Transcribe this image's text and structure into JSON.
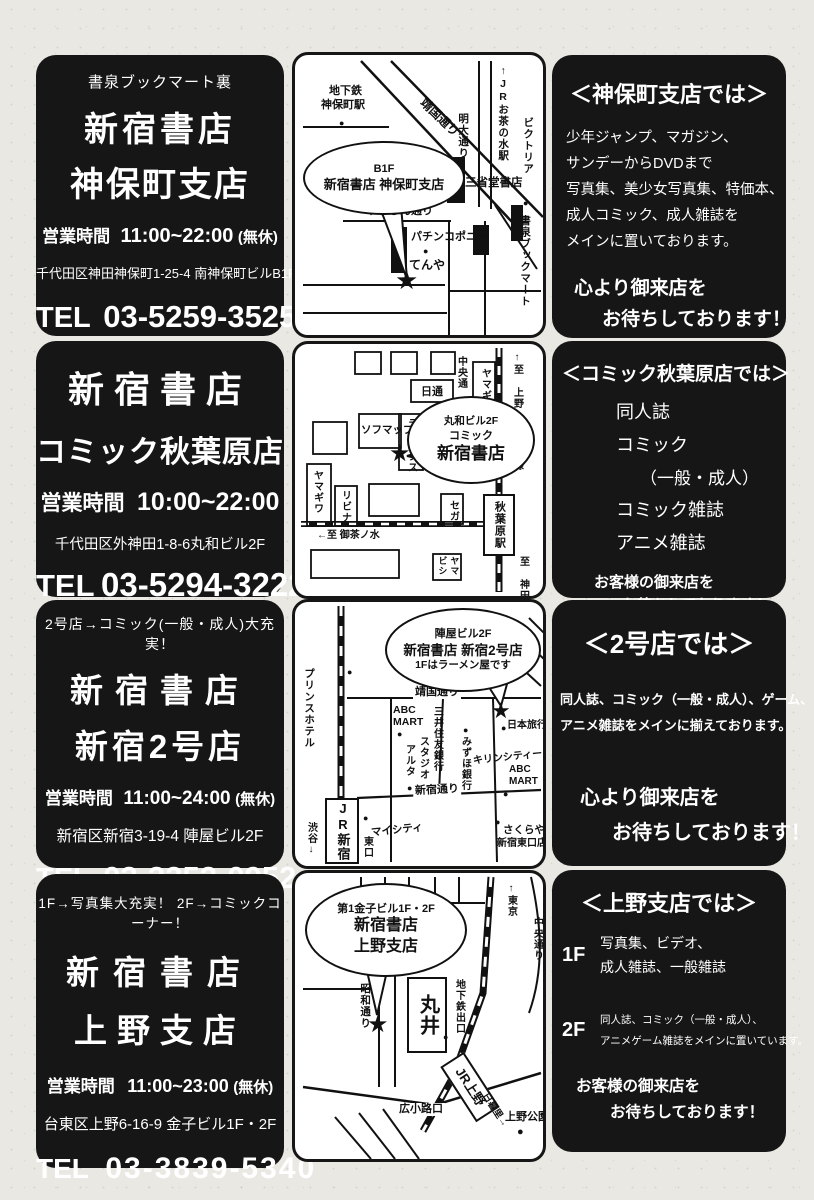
{
  "icons": {
    "star": "★",
    "dot": "●"
  },
  "stores": [
    {
      "info": {
        "tagline": "書泉ブックマート裏",
        "name1": "新宿書店",
        "name2": "神保町支店",
        "hours_label": "営業時間",
        "hours": "11:00~22:00",
        "hours_note": "(無休)",
        "address": "千代田区神田神保町1-25-4 南神保町ビルB1F",
        "tel_label": "TEL",
        "tel": "03-5259-3525"
      },
      "map": {
        "subway1": "地下鉄",
        "subway2": "神保町駅",
        "yasukuni": "靖国通り",
        "jr_ochanomizu": "↑JRお茶の水駅",
        "meidai": "明大通り",
        "victoria": "ビクトリア",
        "sanseido": "三省堂書店",
        "suzuran": "すずらん通り",
        "pachinko": "パチンコポニー",
        "tenya": "てんや",
        "shosen": "書泉ブックマート",
        "balloon1": "B1F",
        "balloon2": "新宿書店 神保町支店"
      },
      "desc": {
        "heading": "＜神保町支店では＞",
        "line1": "少年ジャンプ、マガジン、",
        "line2": "サンデーからDVDまで",
        "line3": "写真集、美少女写真集、特価本、",
        "line4": "成人コミック、成人雑誌を",
        "line5": "メインに置いております。",
        "closing1": "心より御来店を",
        "closing2": "お待ちしております！"
      }
    },
    {
      "info": {
        "name1": "新宿書店",
        "name2": "コミック秋葉原店",
        "hours_label": "営業時間",
        "hours": "10:00~22:00",
        "address": "千代田区外神田1-8-6丸和ビル2F",
        "tel_label": "TEL",
        "tel": "03-5294-3222"
      },
      "map": {
        "chuo": "中央通",
        "yamagiwa_top": "ヤマギワ",
        "to_ueno": "↑至 上野",
        "yamanote": "山手線",
        "nittsu": "日通",
        "laox": "ラオックス",
        "sofmap": "ソフマップ",
        "balloon1": "丸和ビル2F",
        "balloon2": "コミック",
        "balloon3": "新宿書店",
        "yamagiwa_left": "ヤマギワ",
        "livina": "リビナ",
        "sega": "セガ",
        "station": "秋葉原駅",
        "to_ochanomizu": "←至 御茶ノ水",
        "yamabishi1": "ヤマ",
        "yamabishi2": "ビシ",
        "to_kanda": "至 神田↓"
      },
      "desc": {
        "heading": "＜コミック秋葉原店では＞",
        "item1": "同人誌",
        "item2": "コミック",
        "item3": "（一般・成人）",
        "item4": "コミック雑誌",
        "item5": "アニメ雑誌",
        "closing1": "お客様の御来店を",
        "closing2": "お待ちしております！"
      }
    },
    {
      "info": {
        "tagline": "2号店→コミック(一般・成人)大充実！",
        "name1": "新宿書店",
        "name2": "新宿2号店",
        "hours_label": "営業時間",
        "hours": "11:00~24:00",
        "hours_note": "(無休)",
        "address": "新宿区新宿3-19-4 陣屋ビル2F",
        "tel_label": "TEL",
        "tel": "03-3352-0952"
      },
      "map": {
        "balloon1": "陣屋ビル2F",
        "balloon2": "新宿書店 新宿2号店",
        "balloon3": "1Fはラーメン屋です",
        "prince": "プリンスホテル",
        "yasukuni": "靖国通り",
        "abc1": "ABC",
        "abc2": "MART",
        "mitsui": "三井住友銀行",
        "studio": "スタジオ",
        "alta": "アルタ",
        "mizuho": "みずほ銀行",
        "kirin": "キリンシティー",
        "nihon_ryoko": "日本旅行",
        "shinjuku_dori": "新宿通り",
        "jr_shinjuku": "JR新宿",
        "shibuya": "渋谷↓",
        "mycity": "マイシティ",
        "higashi": "東口",
        "sakuraya1": "さくらや",
        "sakuraya2": "新宿東口店"
      },
      "desc": {
        "heading": "＜2号店では＞",
        "line1": "同人誌、コミック（一般・成人）、ゲーム、",
        "line2": "アニメ雑誌をメインに揃えております。",
        "closing1": "心より御来店を",
        "closing2": "お待ちしております！"
      }
    },
    {
      "info": {
        "tagline": "1F→写真集大充実！ 2F→コミックコーナー！",
        "name1": "新宿書店",
        "name2": "上野支店",
        "hours_label": "営業時間",
        "hours": "11:00~23:00",
        "hours_note": "(無休)",
        "address": "台東区上野6-16-9 金子ビル1F・2F",
        "tel_label": "TEL",
        "tel": "03-3839-5340"
      },
      "map": {
        "balloon1": "第1金子ビル1F・2F",
        "balloon2": "新宿書店",
        "balloon3": "上野支店",
        "showa": "昭和通り",
        "marui": "丸井",
        "subway_exit": "地下鉄出口",
        "to_tokyo": "↑東京",
        "chuo": "中央通り",
        "hirokoji": "広小路口",
        "jr_ueno": "JR上野",
        "nippori": "日暮里→",
        "ueno_park": "上野公園"
      },
      "desc": {
        "heading": "＜上野支店では＞",
        "f1": "1F",
        "f1l1": "写真集、ビデオ、",
        "f1l2": "成人雑誌、一般雑誌",
        "f2": "2F",
        "f2l1": "同人誌、コミック（一般・成人）、",
        "f2l2": "アニメゲーム雑誌をメインに置いています。",
        "closing1": "お客様の御来店を",
        "closing2": "お待ちしております！"
      }
    }
  ]
}
